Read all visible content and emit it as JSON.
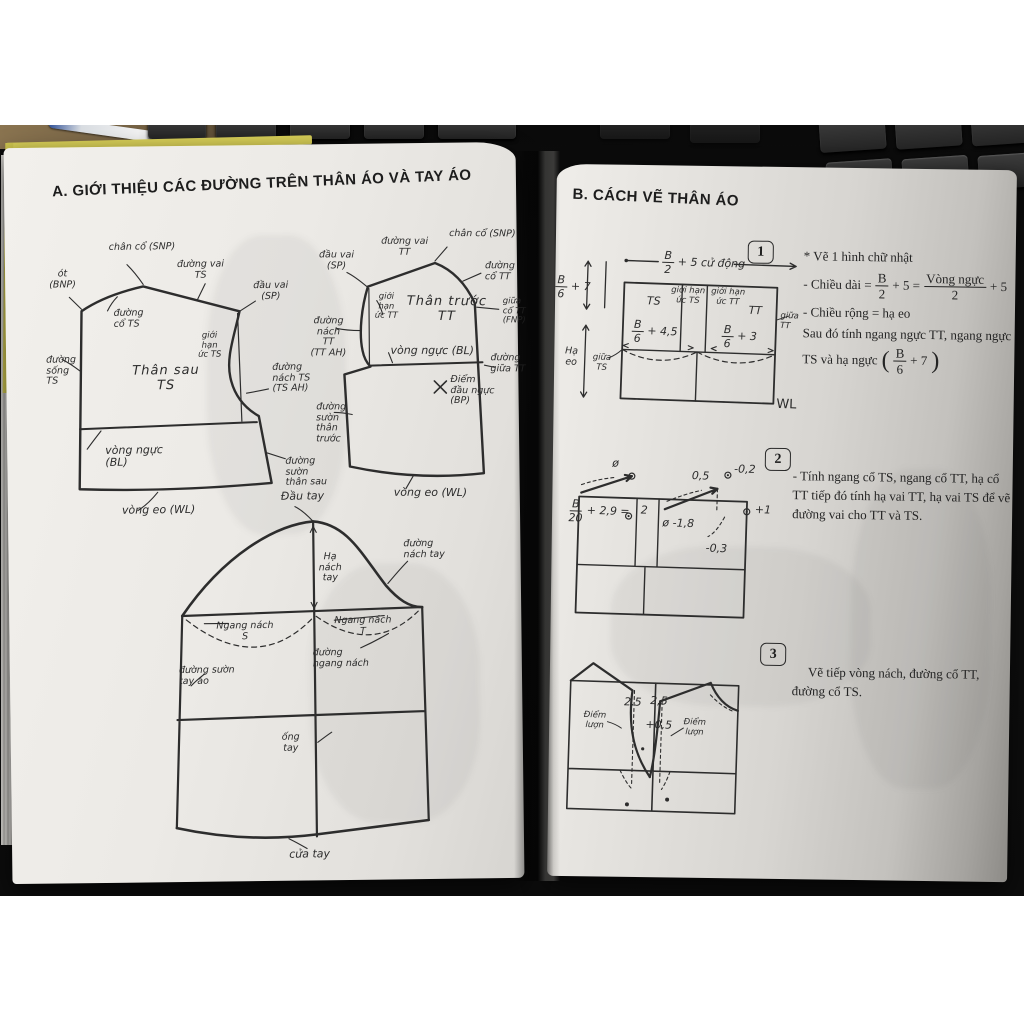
{
  "left_page": {
    "title": "A. GIỚI THIỆU CÁC ĐƯỜNG TRÊN THÂN ÁO VÀ TAY ÁO",
    "back_bodice": {
      "neck_base": "chân cổ (SNP)",
      "shoulder_line": "đường vai\nTS",
      "nape": "ót\n(BNP)",
      "neck_line": "đường\ncổ TS",
      "shoulder_tip": "đầu vai\n(SP)",
      "chest_limit": "giới\nhạn\nức TS",
      "center_back": "đường\nsống\nTS",
      "name": "Thân sau\nTS",
      "armhole": "đường\nnách TS\n(TS AH)",
      "bust_line": "vòng ngực\n(BL)",
      "side_seam": "đường\nsườn\nthân sau",
      "waist_line": "vòng eo (WL)"
    },
    "front_bodice": {
      "shoulder_tip": "đầu vai\n(SP)",
      "shoulder_line": "đường vai\nTT",
      "neck_base": "chân cổ (SNP)",
      "neck_line": "đường\ncổ TT",
      "center_neck": "giữa\ncổ TT\n(FNP)",
      "chest_limit": "giới\nhạn\nức TT",
      "name": "Thân trước\nTT",
      "armhole": "đường\nnách\nTT\n(TT AH)",
      "bust_line": "vòng ngực (BL)",
      "center_front": "đường\ngiữa TT",
      "bust_point": "Điểm\nđầu ngực\n(BP)",
      "side_seam": "đường\nsườn\nthân\ntrước",
      "waist_line": "vòng eo (WL)"
    },
    "sleeve": {
      "cap": "Đầu tay",
      "cap_height": "Hạ\nnách\ntay",
      "cap_curve": "đường\nnách tay",
      "underarm_back": "Ngang nách\nS",
      "underarm_front": "Ngang nách\nT",
      "underarm_line": "đường\nngang nách",
      "side_seam": "đường sườn\ntay áo",
      "sleeve_tube": "ống\ntay",
      "cuff": "cửa tay"
    }
  },
  "right_page": {
    "title": "B. CÁCH VẼ THÂN ÁO",
    "step1": {
      "number": "1",
      "diagram": {
        "top_frac_num": "B",
        "top_frac_den": "2",
        "top_suffix": "+ 5 cử động",
        "left_frac_num": "B",
        "left_frac_den": "6",
        "left_suffix": "+ 7",
        "drop_waist": "Hạ\neo",
        "center_back": "giữa\nTS",
        "back": "TS",
        "limit_back": "giới hạn\nức TS",
        "limit_front": "giới hạn\nức TT",
        "front": "TT",
        "back_frac_num": "B",
        "back_frac_den": "6",
        "back_suffix": "+ 4,5",
        "front_frac_num": "B",
        "front_frac_den": "6",
        "front_suffix": "+ 3",
        "center_front": "giữa TT",
        "waist": "WL"
      },
      "text": {
        "line1": "* Vẽ 1 hình chữ nhật",
        "line2_prefix": "- Chiều dài =",
        "frac1_num": "B",
        "frac1_den": "2",
        "line2_mid": "+ 5 =",
        "frac2_num": "Vòng ngực",
        "frac2_den": "2",
        "line2_suffix": "+ 5",
        "line3": "- Chiều rộng = hạ eo",
        "line4": "Sau đó tính ngang ngực TT, ngang ngực",
        "line5_prefix": "TS và hạ ngực",
        "paren_open": "(",
        "paren_close": ")",
        "frac3_num": "B",
        "frac3_den": "6",
        "line5_suffix": "+ 7"
      }
    },
    "step2": {
      "number": "2",
      "diagram": {
        "neck_frac_num": "B",
        "neck_frac_den": "20",
        "neck_suffix": "+ 2,9 =",
        "angle_back": "ø",
        "two": "2",
        "angle_front": "ø -1,8",
        "half": "0,5",
        "minus02": "-0,2",
        "plus1": "+1",
        "minus03": "-0,3"
      },
      "text": "- Tính ngang cổ TS, ngang cổ TT, hạ cổ TT tiếp đó tính hạ vai TT, hạ vai TS để vẽ đường vai cho TT và TS."
    },
    "step3": {
      "number": "3",
      "diagram": {
        "left25": "2,5",
        "right25": "2,5",
        "plus05": "+0,5",
        "curve_point_left": "Điểm\nlượn",
        "curve_point_right": "Điểm\nlượn"
      },
      "text": "Vẽ tiếp vòng nách, đường cổ TT, đường cổ TS."
    }
  }
}
